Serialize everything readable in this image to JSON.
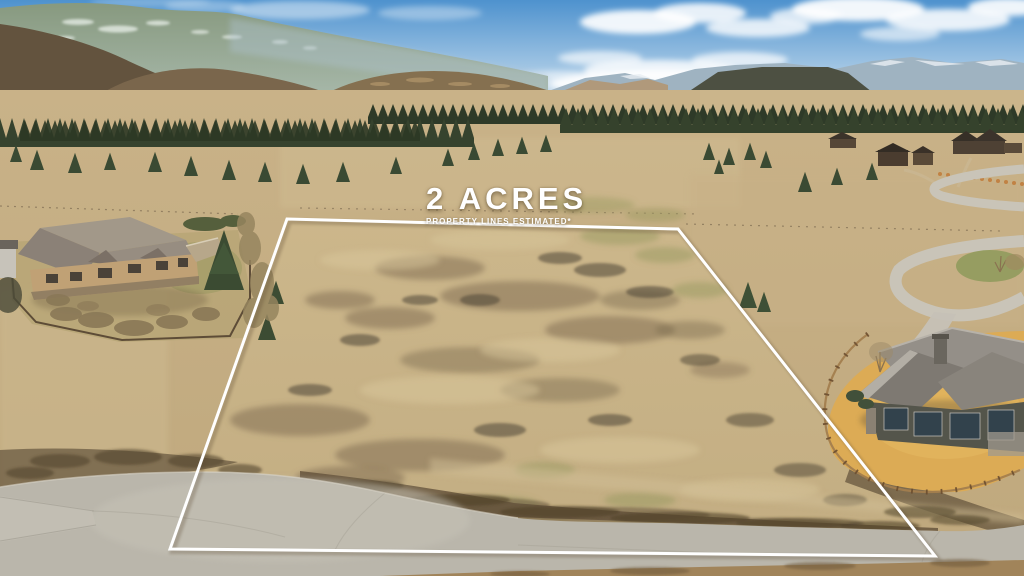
{
  "overlay": {
    "acreage_label": "2 ACRES",
    "disclaimer": "PROPERTY LINES ESTIMATED*"
  },
  "property_boundary": {
    "points": "287,219 678,229 935,556 170,549",
    "stroke_color": "#ffffff"
  },
  "palette": {
    "sky_top": "#4e92ce",
    "sky_horizon": "#d8e7f2",
    "cloud": "#ffffff",
    "mountain_alpine_top": "#87997f",
    "mountain_alpine_bottom": "#a8b9ab",
    "mountain_haze": "#b0c4d3",
    "mountain_snow": "#eaf0ea",
    "foothill_brown": "#6f5d45",
    "conifer": "#36432e",
    "field_tan_top": "#c9b288",
    "field_tan_bottom": "#bfa87d",
    "lot_tan_top": "#cdb88c",
    "lot_tan_bottom": "#c3ae83",
    "scrub_brown": "#63523b",
    "road_gray": "#bab6ab",
    "lawn_gold": "#dcab55",
    "left_house_wall": "#c0a175",
    "right_house_wall": "#54554b",
    "roof_gray": "#8e8880",
    "fence_wood": "#a37e4e"
  }
}
